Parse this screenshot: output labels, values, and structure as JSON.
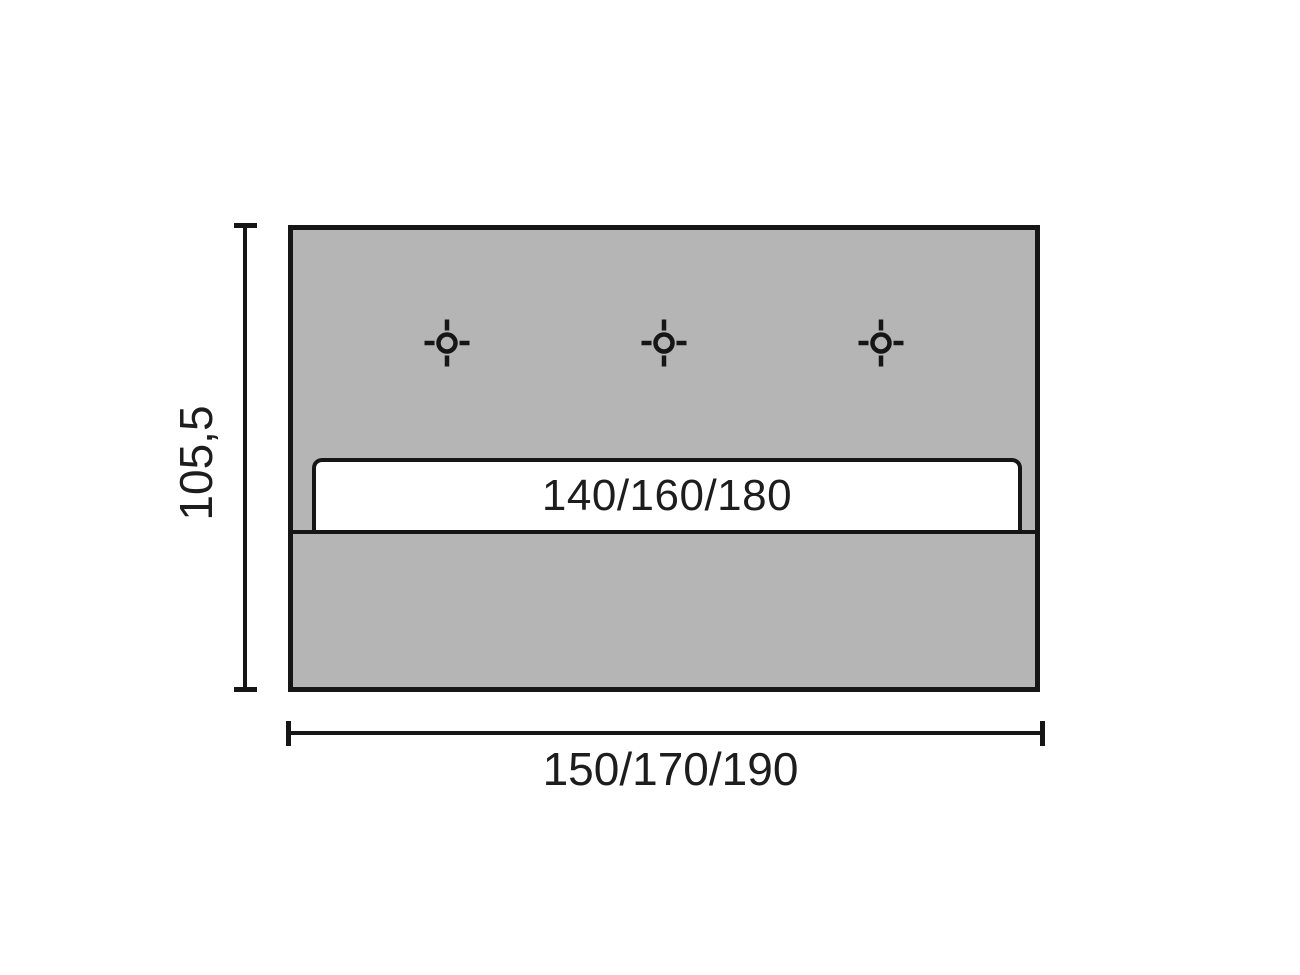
{
  "diagram": {
    "kind": "furniture dimension drawing (headboard front view)",
    "insert_label": "140/160/180",
    "height_label": "105,5",
    "width_label": "150/170/190",
    "drill_hole_count": 3
  },
  "colors": {
    "background": "#ffffff",
    "panel_fill": "#b5b5b5",
    "stroke": "#161616",
    "band_fill": "#ffffff",
    "text": "#1d1d1d"
  }
}
